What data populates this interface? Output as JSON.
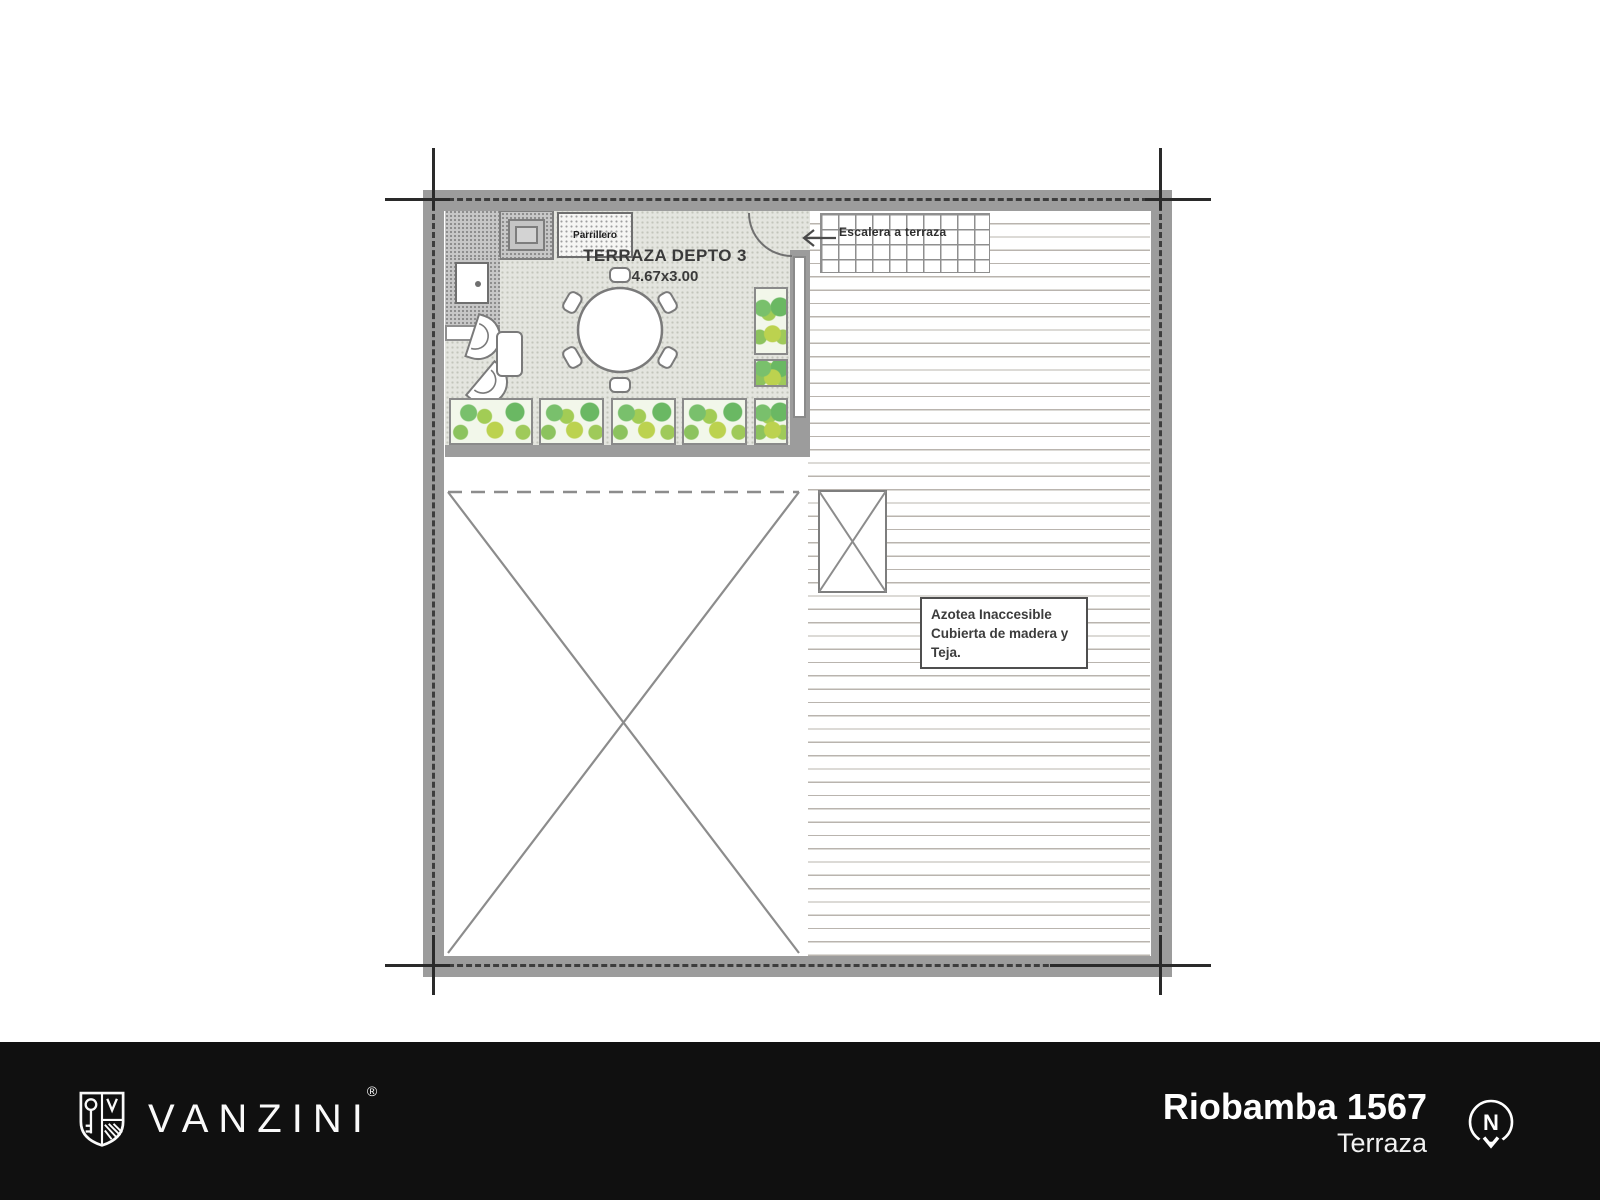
{
  "plan": {
    "terrace_title": "TERRAZA DEPTO 3",
    "terrace_dimensions": "4.67x3.00",
    "grill_label": "Parrillero",
    "stairs_label": "Escalera a terraza",
    "roof_note_line1": "Azotea Inaccesible",
    "roof_note_line2": "Cubierta de madera y",
    "roof_note_line3": "Teja."
  },
  "footer": {
    "brand": "VANZINI",
    "registered_mark": "®",
    "address": "Riobamba 1567",
    "plan_level": "Terraza",
    "compass_letter": "N"
  },
  "colors": {
    "wall_gray": "#9c9c9c",
    "plant_green": "#79c06c",
    "plant_yellow_green": "#bcd24f",
    "footer_bg": "#101010"
  }
}
